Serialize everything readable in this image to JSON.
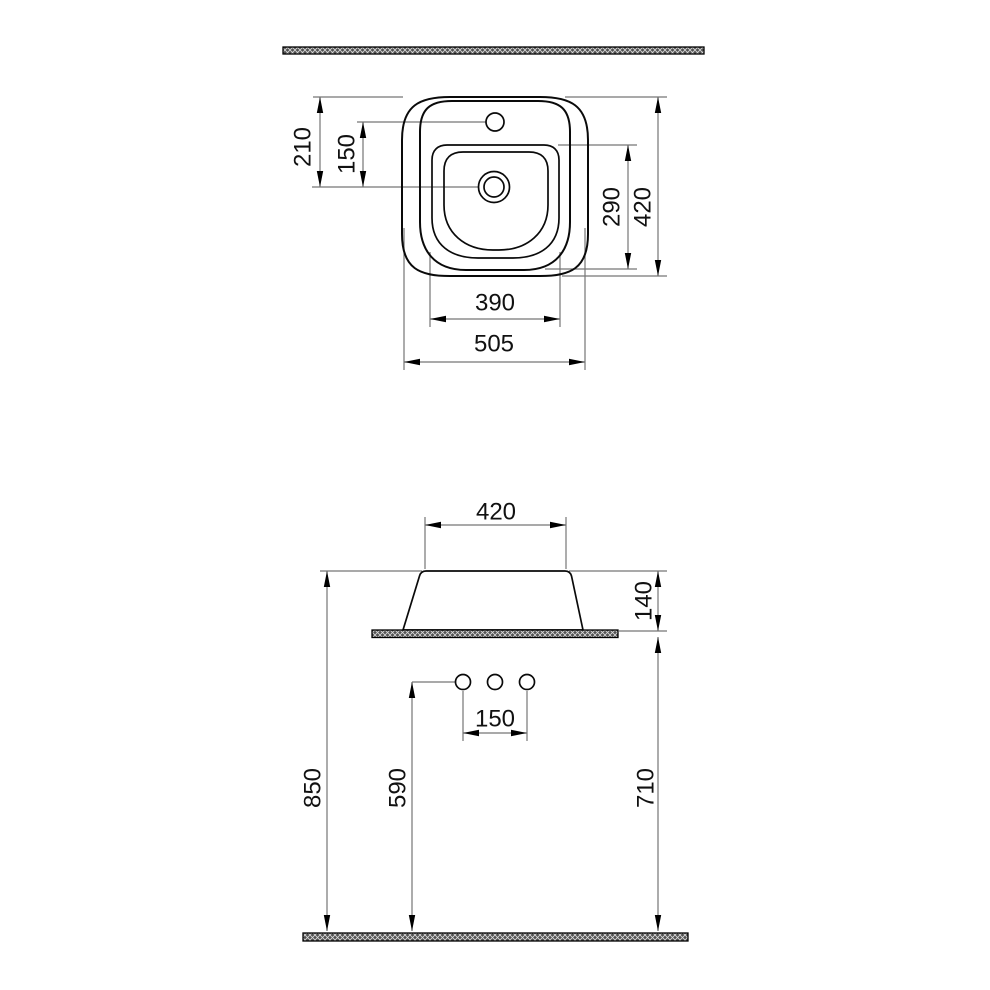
{
  "drawing_type": "sink-technical-dimension-drawing",
  "colors": {
    "background": "#ffffff",
    "object_line": "#0a0a0a",
    "dimension_line": "#767676",
    "hatch_dark": "#525252",
    "hatch_light": "#d9d9d9"
  },
  "views": {
    "top": {
      "label": "plan-view",
      "dims": {
        "rim_to_drain": "210",
        "faucet_to_drain": "150",
        "overall_depth": "420",
        "basin_depth": "290",
        "basin_width": "390",
        "overall_width": "505"
      }
    },
    "front": {
      "label": "front-view",
      "dims": {
        "rim_width": "420",
        "rim_above_counter": "140",
        "counter_height": "710",
        "rim_height": "850",
        "holes_height": "590",
        "hole_spacing": "150"
      }
    }
  }
}
